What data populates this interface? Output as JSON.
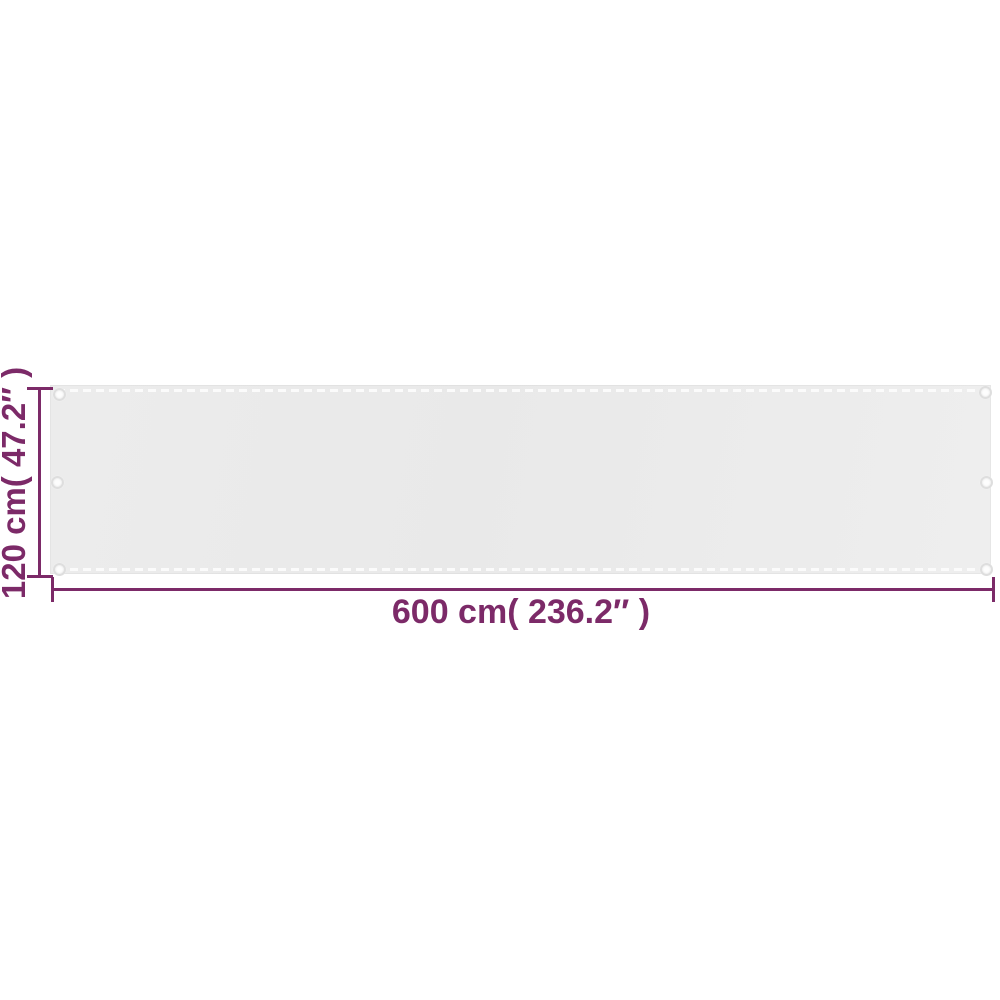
{
  "product_diagram": {
    "description": "balcony-screen-dimension-diagram",
    "panel": {
      "fill_color": "#eaeaea",
      "stitch_color": "#fbfbfb",
      "grommet_count": 6
    },
    "dimensions": {
      "height_label": "120 cm( 47.2″ )",
      "width_label": "600 cm( 236.2″ )",
      "accent_color": "#7c2a68"
    }
  }
}
